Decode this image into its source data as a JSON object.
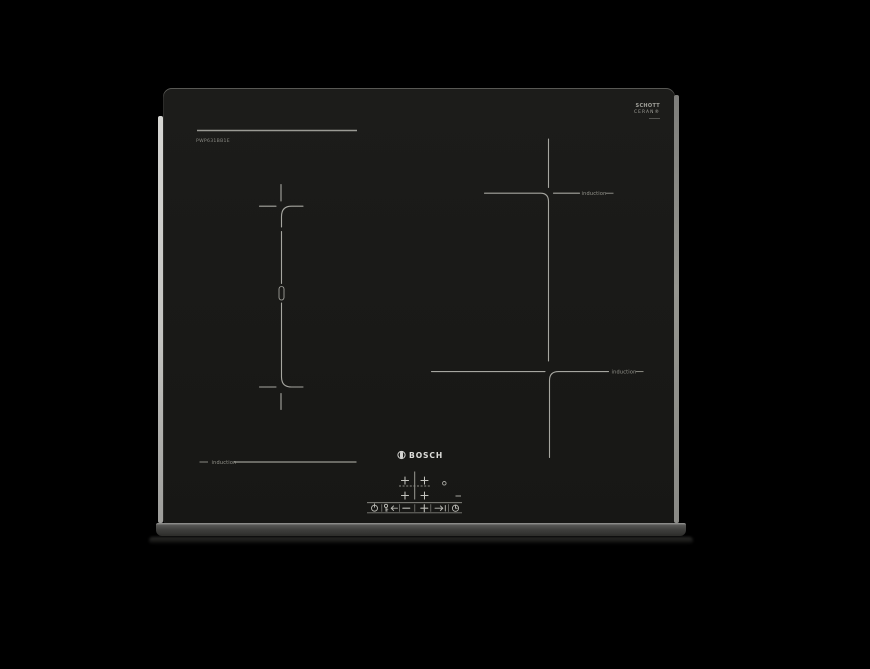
{
  "product": {
    "brand_wordmark": "BOSCH",
    "model_number": "PWP631BB1E",
    "glass_brand": {
      "line1": "SCHOTT",
      "line2": "CERAN®"
    }
  },
  "zone_labels": {
    "top_right": "induction",
    "bottom_right": "induction",
    "bottom_left": "induction"
  },
  "zone_selectors": {
    "front_left": "+",
    "front_right": "+",
    "rear_left": "+",
    "rear_right": "+"
  },
  "control_strip": {
    "icons": [
      "power-icon",
      "key-lock-icon",
      "arrow-left-icon",
      "minus-key-icon",
      "plus-key-icon",
      "boost-arrow-icon",
      "timer-clock-icon"
    ]
  },
  "colors": {
    "background": "#000000",
    "glass": "#1a1a18",
    "marking_line": "#a6a6a0",
    "label_text": "#97978f",
    "bosch_text": "#dededb",
    "edge_highlight": "#c6c6c3",
    "front_trim": "#3d3d3b"
  }
}
